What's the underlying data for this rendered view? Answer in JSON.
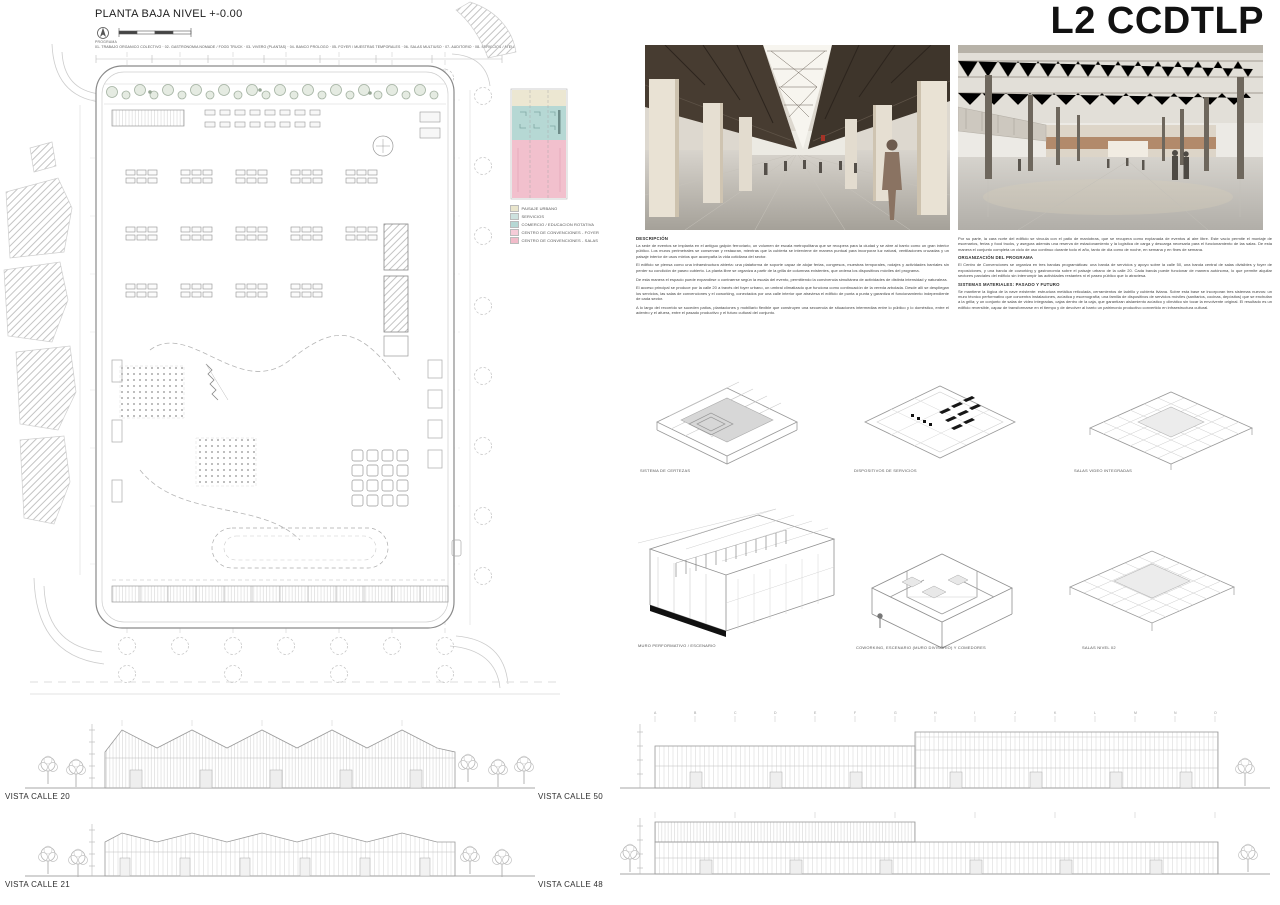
{
  "board_title": "L2 CCDTLP",
  "plan": {
    "title": "PLANTA BAJA NIVEL +-0.00",
    "program_label": "PROGRAMA",
    "program_line": "01- TRABAJO ORGANICO COLECTIVO · 02- GASTRONOMIA NOMADE / FOOD TRUCK · 03- VIVERO (PLANTAS) · 04- BANCO PROLOGO · 05- FOYER / MUESTRAS TEMPORALES · 06- SALAS MULTIUSO · 07- AUDITORIO · 08- SERVICIOS / ATELIER ABIERTO"
  },
  "legend": {
    "items": [
      {
        "label": "PAISAJE URBANO",
        "color": "#e9e5cc"
      },
      {
        "label": "SERVICIOS",
        "color": "#cde1de"
      },
      {
        "label": "COMERCIO / EDUCACION ROTATIVA",
        "color": "#b6d8d4"
      },
      {
        "label": "CENTRO DE CONVENCIONES - FOYER",
        "color": "#f5ccd8"
      },
      {
        "label": "CENTRO DE CONVENCIONES - SALAS",
        "color": "#f1bbc9"
      }
    ]
  },
  "memoria": {
    "col1": {
      "heading": "DESCRIPCIÓN",
      "p1": "La sede de eventos se implanta en el antiguo galpón ferroviario, un volumen de escala metropolitana que se recupera para la ciudad y se abre al barrio como un gran interior público. Los muros perimetrales se conservan y restauran, mientras que la cubierta se interviene de manera puntual para incorporar luz natural, ventilaciones cruzadas y un paisaje interior de usos mixtos que acompaña la vida cotidiana del sector.",
      "p2": "El edificio se piensa como una infraestructura abierta: una plataforma de soporte capaz de alojar ferias, congresos, muestras temporales, rodajes y actividades barriales sin perder su condición de paseo cubierto. La planta libre se organiza a partir de la grilla de columnas existentes, que ordena los dispositivos móviles del programa.",
      "p3": "De esta manera el espacio puede expandirse o contraerse según la escala del evento, permitiendo la convivencia simultánea de actividades de distinta intensidad y naturaleza.",
      "p4": "El acceso principal se produce por la calle 20 a través del foyer urbano, un umbral climatizado que funciona como continuación de la vereda arbolada. Desde allí se despliegan los servicios, las salas de convenciones y el coworking, conectados por una calle interior que atraviesa el edificio de punta a punta y garantiza el funcionamiento independiente de cada sector.",
      "p5": "A lo largo del recorrido se suceden patios, plantaciones y mobiliario flexible que construyen una secuencia de situaciones intermedias entre lo público y lo doméstico, entre el adentro y el afuera, entre el pasado productivo y el futuro cultural del conjunto."
    },
    "col2": {
      "p0": "Por su parte, la cara norte del edificio se vincula con el patio de maniobras, que se recupera como explanada de eventos al aire libre. Este vacío permite el montaje de escenarios, ferias y food trucks, y asegura además una reserva de estacionamiento y la logística de carga y descarga necesaria para el funcionamiento de las salas. De esta manera el conjunto completa un ciclo de uso continuo durante todo el año, tanto de día como de noche, en semana y en fines de semana.",
      "heading1": "ORGANIZACIÓN DEL PROGRAMA",
      "p1": "El Centro de Convenciones se organiza en tres bandas programáticas: una banda de servicios y apoyo sobre la calle 50, una banda central de salas divisibles y foyer de exposiciones, y una banda de coworking y gastronomía sobre el paisaje urbano de la calle 20. Cada banda puede funcionar de manera autónoma, lo que permite alquilar sectores parciales del edificio sin interrumpir las actividades restantes ni el paseo público que lo atraviesa.",
      "heading2": "SISTEMAS MATERIALES: PASADO Y FUTURO",
      "p2": "Se mantiene la lógica de la nave existente: estructura metálica reticulada, cerramientos de ladrillo y cubierta liviana. Sobre esta base se incorporan tres sistemas nuevos: un muro técnico performativo que concentra instalaciones, acústica y escenografía; una familia de dispositivos de servicios móviles (sanitarios, cocinas, depósitos) que se enchufan a la grilla; y un conjunto de salas de video integradas, cajas dentro de la caja, que garantizan aislamiento acústico y climático sin tocar la envolvente original. El resultado es un edificio reversible, capaz de transformarse en el tiempo y de devolver al barrio un patrimonio productivo convertido en infraestructura cultural."
    }
  },
  "axonometrics": {
    "a1": {
      "label": "SISTEMA DE CERTEZAS"
    },
    "a2": {
      "label": "DISPOSITIVOS DE SERVICIOS"
    },
    "a3": {
      "label": "SALAS VIDEO INTEGRADAS"
    },
    "a4": {
      "label": "MURO PERFORMATIVO / ESCENARIO"
    },
    "a5": {
      "label": "COWORKING, ESCENARIO (MURO DIVISORIO) Y COMEDORES"
    },
    "a6": {
      "label": "SALAS NIVEL 02"
    }
  },
  "elevations": {
    "e1": {
      "label": "VISTA CALLE 20"
    },
    "e2": {
      "label": "VISTA CALLE 21"
    },
    "e3": {
      "label": "VISTA CALLE 50"
    },
    "e4": {
      "label": "VISTA CALLE 48"
    }
  }
}
